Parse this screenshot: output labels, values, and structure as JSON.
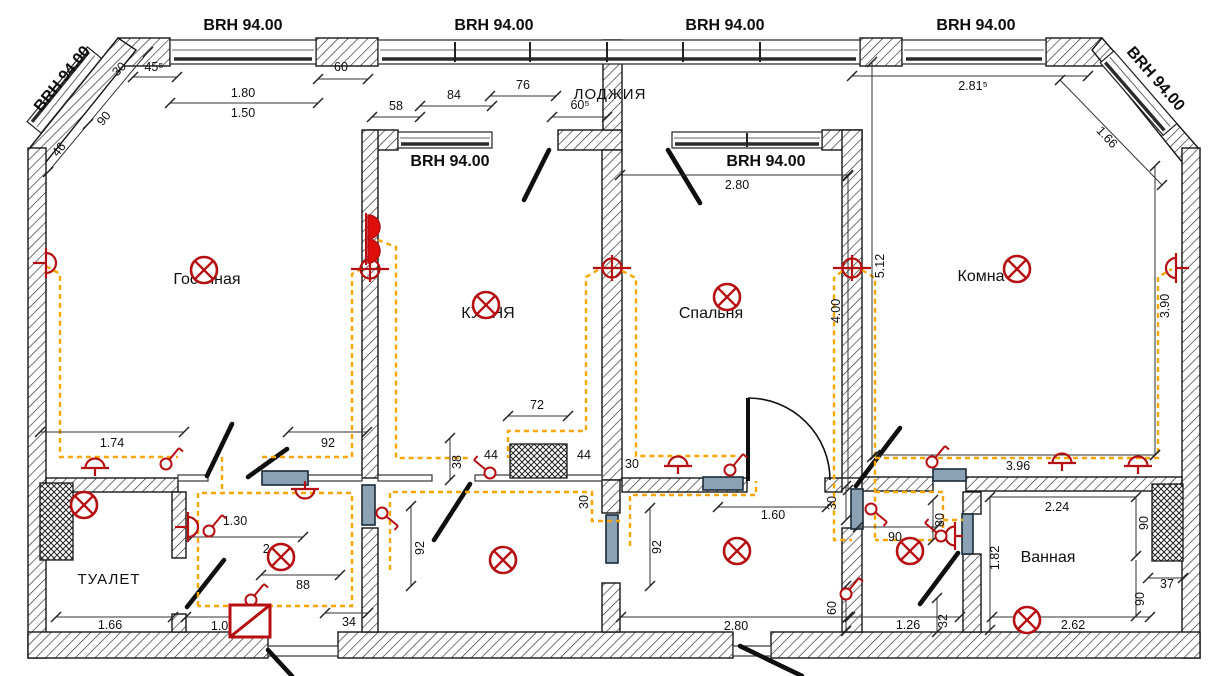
{
  "plan": {
    "brh_mark": "BRH 94.00",
    "rooms": {
      "living": "Гостиная",
      "kitchen": "КУХНЯ",
      "bedroom": "Спальня",
      "room": "Комна",
      "toilet": "ТУАЛЕТ",
      "bath": "Ванная",
      "loggia": "ЛОДЖИЯ"
    },
    "dims": {
      "d30": "30",
      "d455": "45⁵",
      "d46": "46",
      "d90": "90",
      "d180": "1.80",
      "d150": "1.50",
      "d60": "60",
      "d58": "58",
      "d84": "84",
      "d76": "76",
      "d605": "60⁵",
      "d2815": "2.81⁵",
      "d166": "1.66",
      "d280": "2.80",
      "d400": "4.00",
      "d512": "5.12",
      "d390": "3.90",
      "d396": "3.96",
      "d174": "1.74",
      "d92": "92",
      "d72": "72",
      "d38": "38",
      "d44": "44",
      "d130": "1.30",
      "d2": "2.",
      "d88": "88",
      "d100": "1.00",
      "d34": "34",
      "d160": "1.60",
      "d126": "1.26",
      "d32": "32",
      "d80": "80",
      "d182": "1.82",
      "d224": "2.24",
      "d37": "37",
      "d262": "2.62"
    },
    "colors": {
      "symbol_red": "#b50f12",
      "wire_orange": "#f7a600",
      "fixture_blue": "#8aa2b4",
      "line_dark": "#151515"
    }
  }
}
